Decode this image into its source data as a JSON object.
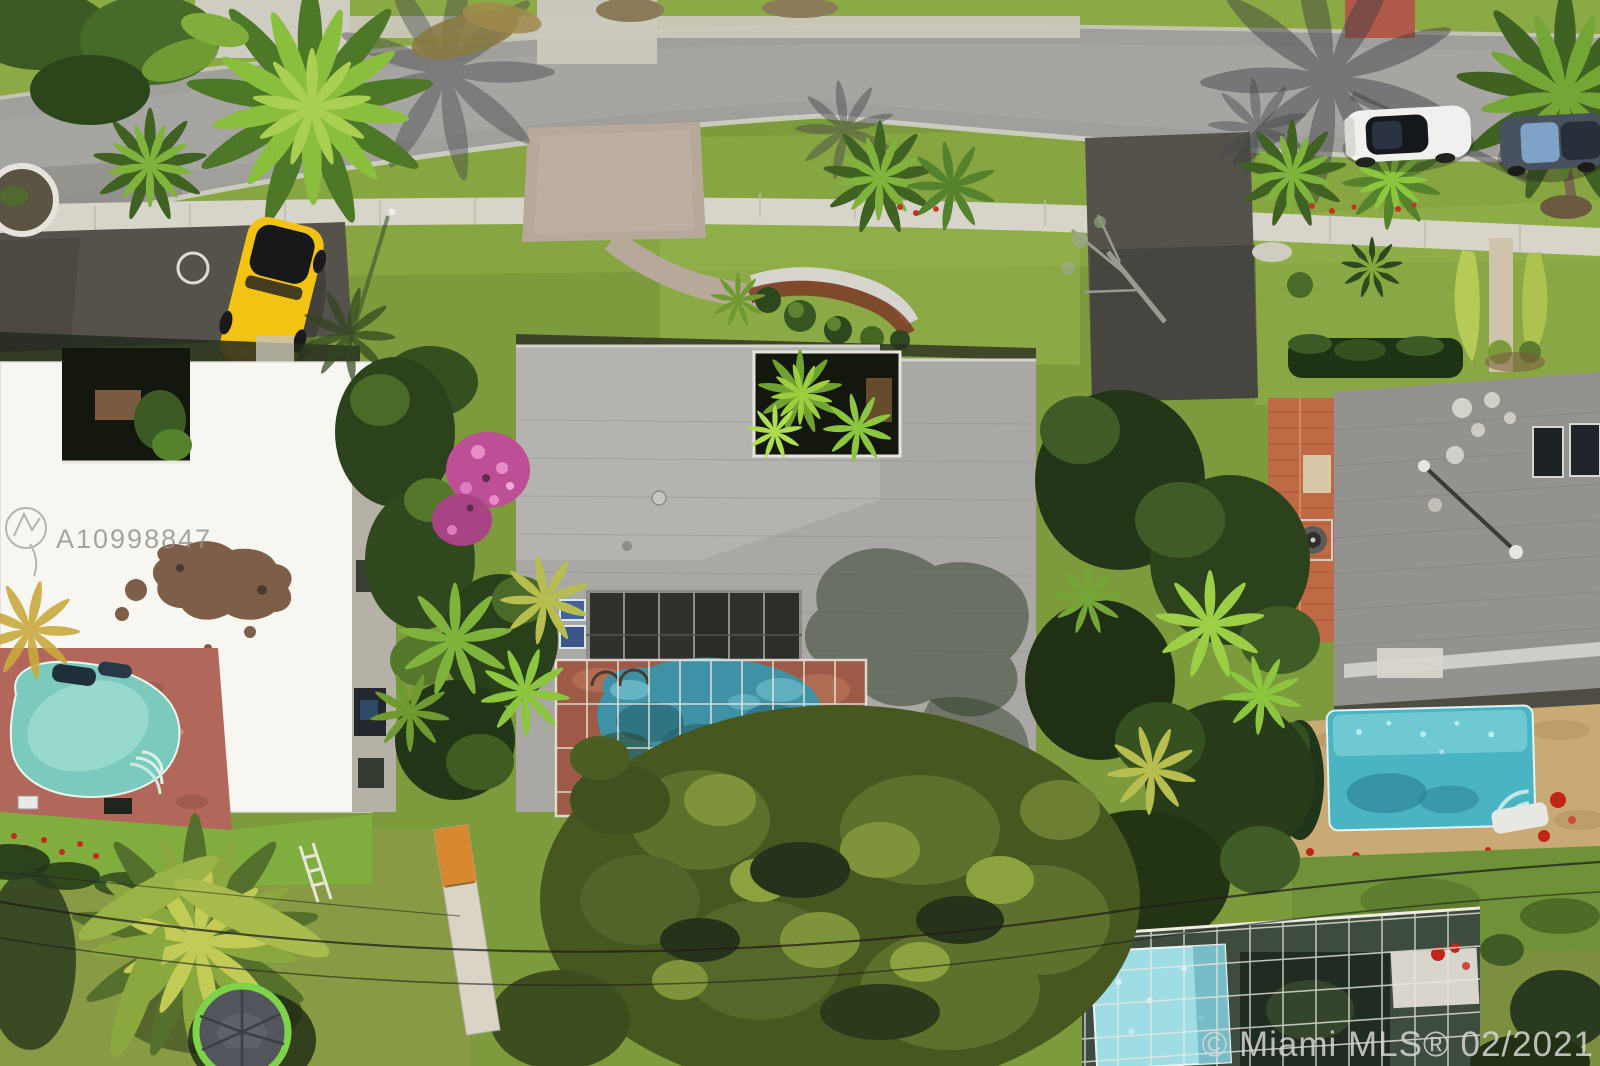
{
  "image": {
    "kind": "aerial-drone-photo",
    "description": "Overhead aerial view of a suburban street with three houses, swimming pools, palm trees, parked cars and a trampoline"
  },
  "watermarks": {
    "mls_id": "A10998847",
    "copyright": "© Miami MLS® 02/2021"
  },
  "colors": {
    "grass_base": "#7d9a3c",
    "road_asphalt": "#a09f9b",
    "sidewalk": "#d7d4ca",
    "paver_driveway": "#b7a999",
    "dark_asphalt": "#55524b",
    "left_house_roof": "#f7f6f1",
    "center_house_roof": "#a9a8a4",
    "right_house_roof": "#93928e",
    "entry_tile_roof": "#c06a45",
    "brick_pool_deck": "#b1685a",
    "center_pool_deck": "#9d5a46",
    "sand_pool_deck": "#c9a974",
    "left_pool": "#7ccabe",
    "center_pool": "#3f92a6",
    "right_pool": "#4ab4c2",
    "enclosed_pool": "#9fdde4",
    "screen_white": "#edeae1",
    "yellow_car": "#f2c313",
    "white_car": "#f0f0ee",
    "dark_car": "#47525e",
    "trampoline_ring": "#7ed348",
    "trampoline_mat": "#53555c",
    "watermark_gray": "#949290",
    "watermark_light": "#d7d6d4"
  }
}
